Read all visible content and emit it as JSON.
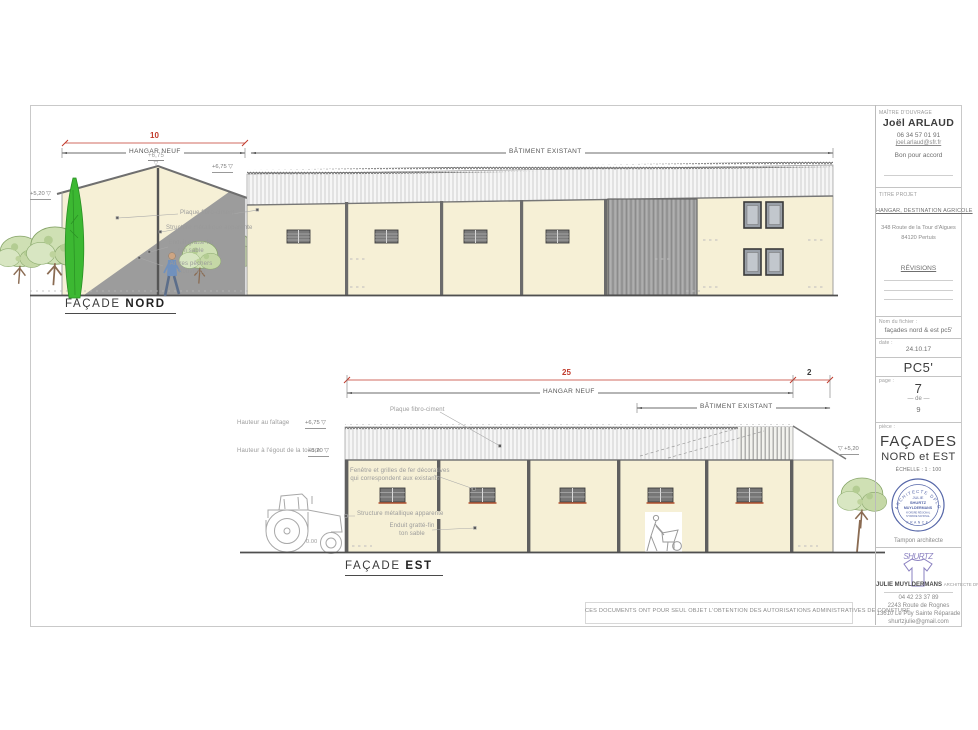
{
  "symbols": {
    "tri": "▽"
  },
  "colors": {
    "accent_red": "#c13a2b",
    "wall_cream": "#f6f0d6",
    "enduit_gray": "#9c9c9c",
    "stamp_blue": "#5566a8",
    "tree_green": "#cfe0b4",
    "cypress_green": "#3cb832"
  },
  "facade_nord": {
    "title": "FAÇADE",
    "title_bold": "NORD",
    "dim_red": "10",
    "dim_hangar": "HANGAR NEUF",
    "dim_batiment": "BÂTIMENT EXISTANT",
    "level_ridge": "+6,75",
    "level_eave": "+6,75",
    "level_left": "+5,20",
    "note_plaque": "Plaque fibro-ciment",
    "note_structure": "Structure métallique apparente",
    "note_enduit1": "Enduit gratté-fin",
    "note_enduit2": "ton sable",
    "note_arbres1": "Arbres pêchers",
    "note_arbres2": "(nouveau)"
  },
  "facade_est": {
    "title": "FAÇADE",
    "title_bold": "EST",
    "dim_red": "25",
    "dim_red2": "2",
    "dim_hangar": "HANGAR NEUF",
    "dim_batiment": "BÂTIMENT EXISTANT",
    "lbl_faitage": "Hauteur au faîtage",
    "level_faitage": "+6,75",
    "lbl_egout": "Hauteur à l'égout de la toiture",
    "level_egout": "+5,20",
    "note_plaque": "Plaque fibro-ciment",
    "note_fenetre1": "Fenêtre et grilles de fer décoratives",
    "note_fenetre2": "qui correspondent aux existants",
    "note_structure": "Structure métallique apparente",
    "note_enduit1": "Enduit gratté-fin",
    "note_enduit2": "ton sable",
    "level_right": "+5,20",
    "level_ground": "0.00"
  },
  "footer_note": "CES DOCUMENTS ONT POUR SEUL OBJET L'OBTENTION DES AUTORISATIONS ADMINISTRATIVES DE CONSTURE",
  "titleblock": {
    "maitre_label": "MAÎTRE D'OUVRAGE",
    "maitre_name": "Joël ARLAUD",
    "maitre_phone": "06 34 57 01 91",
    "maitre_email": "joel.arlaud@sfr.fr",
    "accord": "Bon pour accord",
    "titre_label": "TITRE PROJET",
    "projet": "HANGAR, DESTINATION AGRICOLE",
    "adresse1": "348 Route de la Tour d'Aigues",
    "adresse2": "84120 Pertuis",
    "revisions": "RÉVISIONS",
    "fichier_label": "Nom du fichier :",
    "fichier": "façades nord & est pc5'",
    "date_label": "date :",
    "date": "24.10.17",
    "code": "PC5'",
    "page_label": "page :",
    "page": "7",
    "de": "de",
    "total": "9",
    "piece_label": "pièce :",
    "piece1": "FAÇADES",
    "piece2": "NORD et EST",
    "echelle": "ÉCHELLE :   1 : 100",
    "stamp": {
      "arc_top": "ARCHITECTE DPLG",
      "l1": "JULIE",
      "l2": "SHURTZ",
      "l3": "MUYLDERMANS",
      "l4": "N°ORDRE RÉGIONAL",
      "l5": "N°ORDRE NATIONAL",
      "arc_bottom": "FRANCE"
    },
    "tampon": "Tampon architecte",
    "logo_text": "SHURTZ",
    "arch_name": "JULIE MUYLDERMANS",
    "arch_title": "ARCHITECTE DPLG",
    "arch_phone": "04 42 23 37 89",
    "arch_addr1": "2243 Route de Rognes",
    "arch_addr2": "13610 Le Puy Sainte Réparade",
    "arch_email": "shurtzjulie@gmail.com"
  }
}
